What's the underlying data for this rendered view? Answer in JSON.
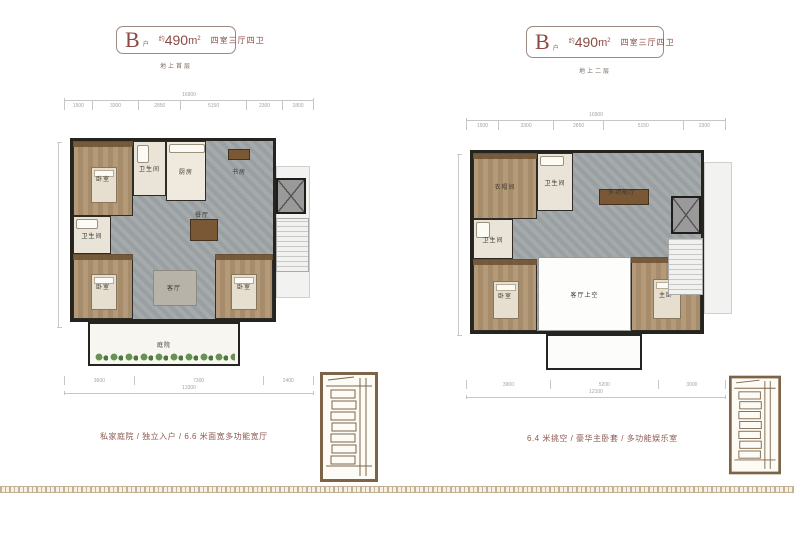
{
  "colors": {
    "accent": "#8a4a42",
    "caption_text": "#8d5a50",
    "badge_border": "#9b8a82",
    "wall": "#26241f",
    "hall_floor": "#a0a6a9",
    "wood_floor": "#b0946f",
    "keyplan_brown": "#7d6448"
  },
  "panels": [
    {
      "badge": {
        "letter": "B",
        "letter_sub": "户",
        "approx_label": "约",
        "area_value": "490",
        "area_unit": "m",
        "area_sup": "2",
        "layout_label": "四室三厅四卫"
      },
      "floor_label": "地上首层",
      "caption": "私家庭院 / 独立入户 / 6.6 米面宽多功能宽厅",
      "dims_top": {
        "total": "16900",
        "segments": [
          "1500",
          "3300",
          "2850",
          "5150",
          "2300",
          "1800"
        ]
      },
      "dims_bottom": {
        "total": "13300",
        "segments": [
          "3600",
          "7300",
          "2400"
        ]
      },
      "rooms": {
        "bedroom_top": "卧室",
        "bath_top": "卫生间",
        "kitchen": "厨房",
        "study": "书房",
        "dining": "餐厅",
        "bath_left": "卫生间",
        "bedroom_left": "卧室",
        "living": "客厅",
        "bedroom_right": "卧室",
        "courtyard": "庭院"
      }
    },
    {
      "badge": {
        "letter": "B",
        "letter_sub": "户",
        "approx_label": "约",
        "area_value": "490",
        "area_unit": "m",
        "area_sup": "2",
        "layout_label": "四室三厅四卫"
      },
      "floor_label": "地上二层",
      "caption": "6.4 米挑空 / 豪华主卧套 / 多功能娱乐室",
      "dims_top": {
        "total": "16900",
        "segments": [
          "1500",
          "3300",
          "2850",
          "5150",
          "2300"
        ]
      },
      "dims_bottom": {
        "total": "12100",
        "segments": [
          "3900",
          "5200",
          "3000"
        ]
      },
      "rooms": {
        "cloakroom": "衣帽间",
        "bath_top": "卫生间",
        "family_room": "多功能厅",
        "bath_left": "卫生间",
        "bedroom_left": "卧室",
        "void": "客厅上空",
        "master_bedroom": "主卧"
      }
    }
  ]
}
